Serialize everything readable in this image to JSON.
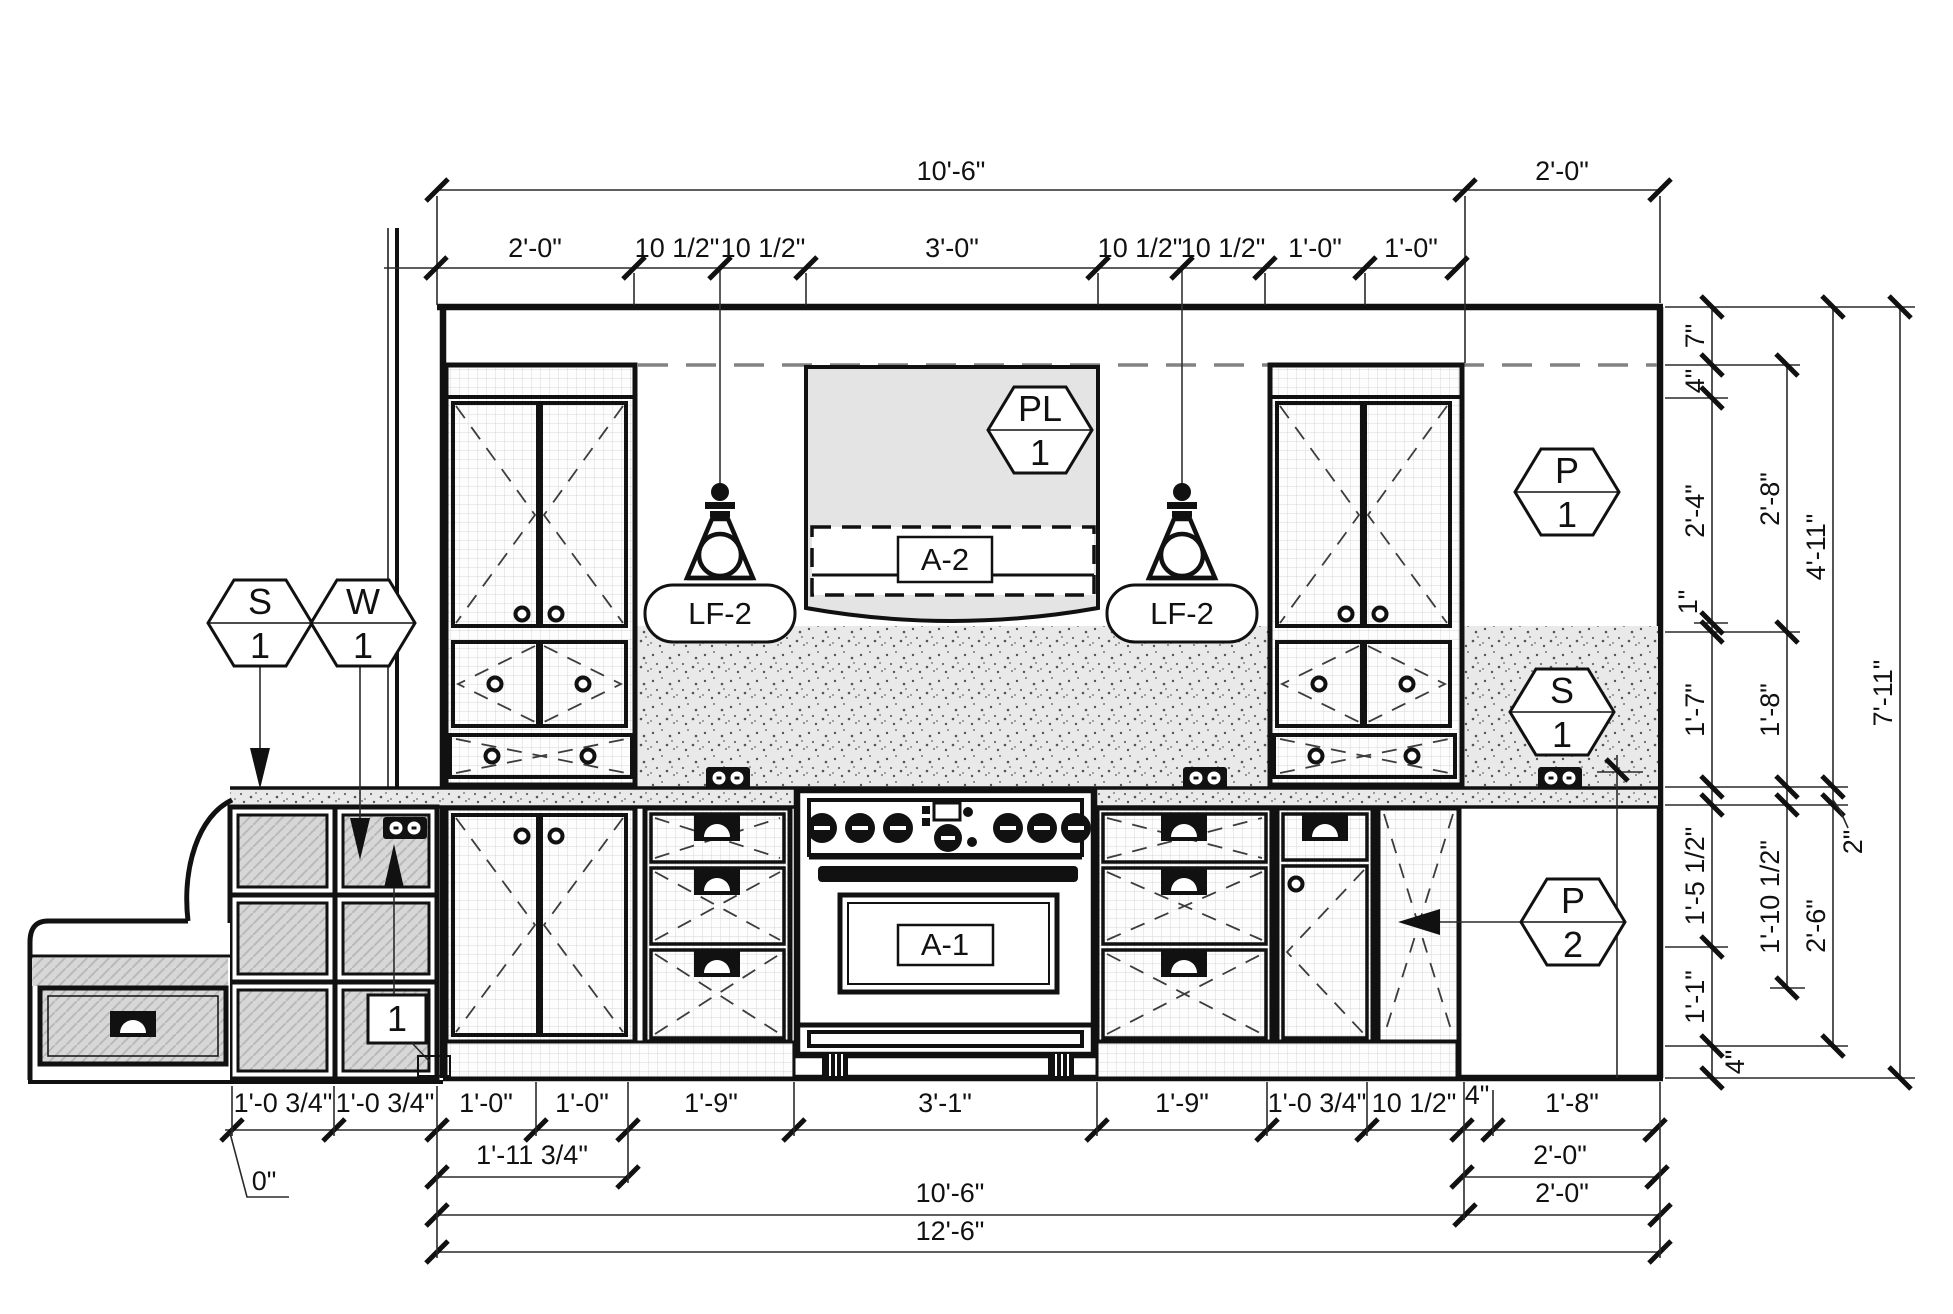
{
  "drawing": {
    "type": "kitchen-elevation"
  },
  "dims": {
    "top_row1": [
      "10'-6\"",
      "2'-0\""
    ],
    "top_row2": [
      "2'-0\"",
      "10 1/2\"",
      "10 1/2\"",
      "3'-0\"",
      "10 1/2\"",
      "10 1/2\"",
      "1'-0\"",
      "1'-0\""
    ],
    "right_col1": [
      "7\"",
      "4\"",
      "2'-4\"",
      "1\"",
      "1'-7\"",
      "1'-5 1/2\"",
      "1'-1\"",
      "4\""
    ],
    "right_col2": [
      "2'-8\"",
      "1'-8\"",
      "1'-10 1/2\""
    ],
    "right_col3": [
      "4'-11\"",
      "2\"",
      "2'-6\""
    ],
    "right_col4": [
      "7'-11\""
    ],
    "bottom_row1": [
      "1'-0 3/4\"",
      "1'-0 3/4\"",
      "1'-0\"",
      "1'-0\"",
      "1'-9\"",
      "3'-1\"",
      "1'-9\"",
      "1'-0 3/4\"",
      "10 1/2\"",
      "4\"",
      "1'-8\""
    ],
    "bottom_row2": [
      "1'-11 3/4\"",
      "2'-0\""
    ],
    "bottom_row3": [
      "10'-6\"",
      "2'-0\""
    ],
    "bottom_row4": [
      "12'-6\""
    ],
    "zero_note": "0\""
  },
  "tags": {
    "surface_left": {
      "letter": "S",
      "number": "1"
    },
    "wall_left": {
      "letter": "W",
      "number": "1"
    },
    "plumbing": {
      "letter": "PL",
      "number": "1"
    },
    "panel_upper_right": {
      "letter": "P",
      "number": "1"
    },
    "surface_right": {
      "letter": "S",
      "number": "1"
    },
    "panel_lower_right": {
      "letter": "P",
      "number": "2"
    }
  },
  "labels": {
    "hood": "A-2",
    "range": "A-1",
    "pendant_left": "LF-2",
    "pendant_right": "LF-2",
    "keynote": "1"
  },
  "colors": {
    "line": "#111111",
    "dim_line": "#2a2a2a",
    "hood_fill": "#e4e4e4",
    "stipple_bg": "#e9e9e9",
    "section_fill": "#d7d7d7",
    "paper": "#ffffff"
  }
}
